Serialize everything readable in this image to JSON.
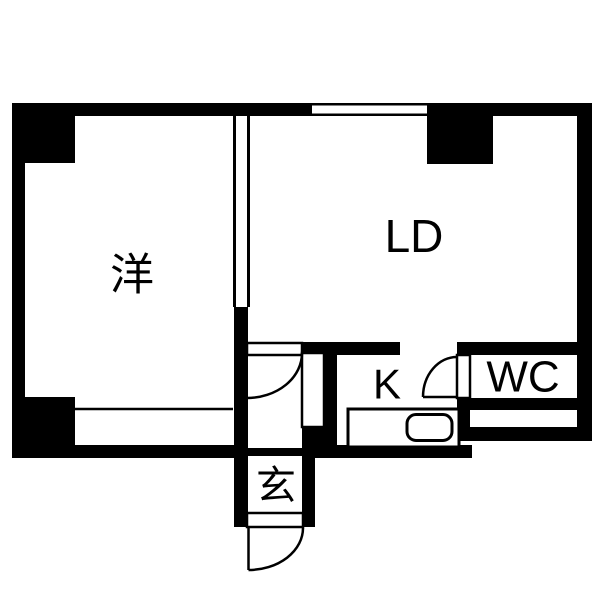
{
  "colors": {
    "wall": "#000000",
    "floor": "#ffffff"
  },
  "rooms": {
    "western": {
      "label": "洋"
    },
    "living_dining": {
      "label": "LD"
    },
    "kitchen": {
      "label": "K"
    },
    "toilet": {
      "label": "WC"
    },
    "entrance": {
      "label": "玄"
    }
  },
  "elements": {
    "window": "window-in-top-wall",
    "doors": [
      "entrance-hinged-door",
      "hall-to-ld-hinged-door",
      "wc-hinged-door"
    ],
    "fixtures": [
      "kitchen-counter",
      "kitchen-sink"
    ]
  }
}
